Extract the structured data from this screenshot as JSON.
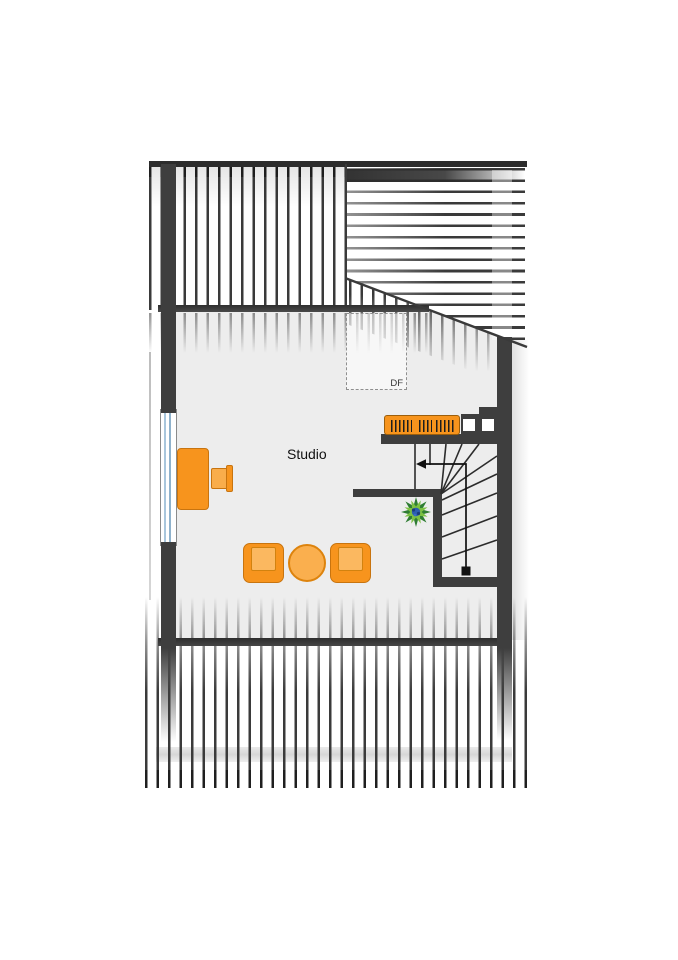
{
  "plan": {
    "type": "floor-plan",
    "labels": {
      "room": "Studio",
      "roof_window": "DF"
    },
    "colors": {
      "wall": "#3e3e3e",
      "floor": "#ededed",
      "hatch_line": "#3a3a3a",
      "furniture_orange": "#f7941d",
      "furniture_seat_light": "#fbb860",
      "furniture_stroke": "#c8740f",
      "window_glass": "#a9c6dc",
      "plant_green_dark": "#2f7d33",
      "plant_green_light": "#7cc142",
      "plant_blue": "#2d5fae"
    },
    "elements": {
      "furniture": [
        "desk",
        "desk-chair",
        "bookshelf",
        "armchair-left",
        "coffee-table",
        "armchair-right",
        "plant"
      ],
      "stair": {
        "walk_arrow_direction": "left",
        "start_marker": "square"
      },
      "roof": {
        "hatched_slopes": [
          "top-left",
          "top-right",
          "bottom"
        ],
        "roof_window": "DF"
      }
    }
  }
}
